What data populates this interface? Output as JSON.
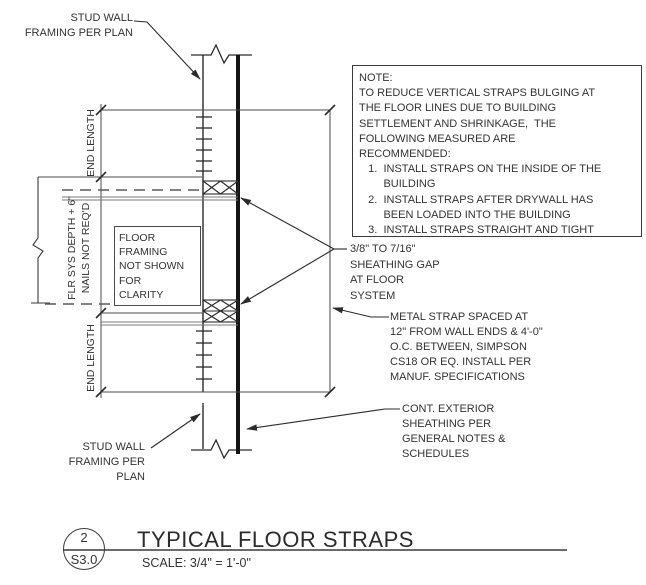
{
  "drawing": {
    "labels": {
      "stud_wall_top": "STUD WALL\nFRAMING PER PLAN",
      "stud_wall_bottom": "STUD WALL\nFRAMING PER\nPLAN",
      "end_length_top": "END LENGTH",
      "end_length_bottom": "END LENGTH",
      "flr_sys": "FLR SYS DEPTH + 6\"\nNAILS NOT REQ'D",
      "floor_framing_box": "FLOOR\nFRAMING\nNOT SHOWN\nFOR\nCLARITY",
      "sheathing_gap": "3/8\" TO 7/16\"\nSHEATHING GAP\nAT FLOOR\nSYSTEM",
      "metal_strap": "METAL STRAP SPACED AT\n12\" FROM WALL ENDS & 4'-0\"\nO.C. BETWEEN, SIMPSON\nCS18 OR EQ. INSTALL PER\nMANUF. SPECIFICATIONS",
      "cont_sheathing": "CONT. EXTERIOR\nSHEATHING PER\nGENERAL NOTES &\nSCHEDULES"
    },
    "note": "NOTE:\nTO REDUCE VERTICAL STRAPS BULGING AT\nTHE FLOOR LINES DUE TO BUILDING\nSETTLEMENT AND SHRINKAGE,  THE\nFOLLOWING MEASURED ARE\nRECOMMENDED:\n   1.  INSTALL STRAPS ON THE INSIDE OF THE\n        BUILDING\n   2.  INSTALL STRAPS AFTER DRYWALL HAS\n        BEEN LOADED INTO THE BUILDING\n   3.  INSTALL STRAPS STRAIGHT AND TIGHT",
    "title_block": {
      "detail_number": "2",
      "sheet_number": "S3.0",
      "title": "TYPICAL FLOOR STRAPS",
      "scale": "SCALE: 3/4\" = 1'-0\""
    },
    "colors": {
      "line": "#2b2b2b",
      "gray_line": "#7a7a7a",
      "background": "#ffffff"
    }
  }
}
